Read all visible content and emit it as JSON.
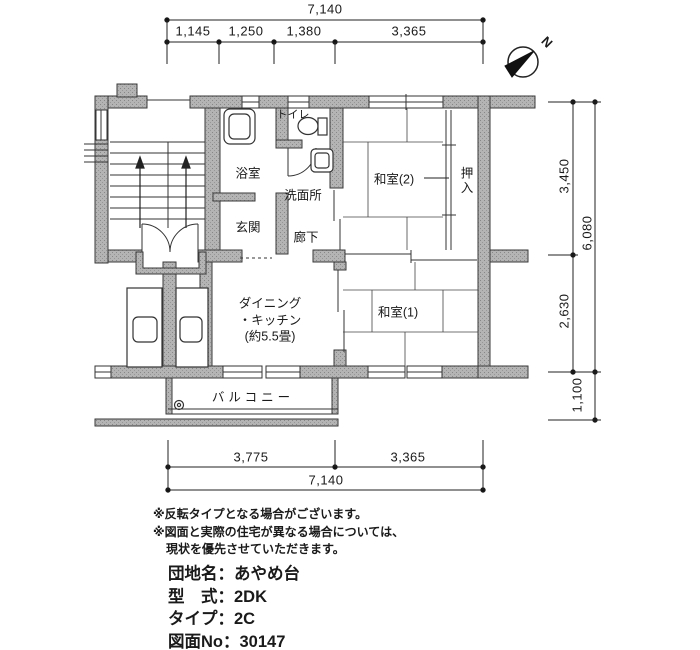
{
  "compass": {
    "north_label": "N"
  },
  "dims": {
    "top_total": "7,140",
    "top_segs": [
      "1,145",
      "1,250",
      "1,380",
      "3,365"
    ],
    "right_segs": [
      "3,450",
      "2,630"
    ],
    "right_total": "6,080",
    "right_balcony": "1,100",
    "bottom_segs": [
      "3,775",
      "3,365"
    ],
    "bottom_total": "7,140"
  },
  "rooms": {
    "toilet": "トイレ",
    "bath": "浴室",
    "washroom": "洗面所",
    "entrance": "玄関",
    "hall": "廊下",
    "japanese_room_2": "和室(2)",
    "closet": "押入",
    "japanese_room_1": "和室(1)",
    "dk_line1": "ダイニング",
    "dk_line2": "・キッチン",
    "dk_line3": "(約5.5畳)",
    "balcony": "バルコニー"
  },
  "notes": [
    "※反転タイプとなる場合がございます。",
    "※図面と実際の住宅が異なる場合については、",
    "現状を優先させていただきます。"
  ],
  "info": [
    {
      "label": "団地名",
      "sep": "：",
      "value": "あやめ台"
    },
    {
      "label": "型　式",
      "sep": "：",
      "value": "2DK"
    },
    {
      "label": "タイプ",
      "sep": "：",
      "value": "2C"
    },
    {
      "label": "図面No",
      "sep": "：",
      "value": "30147"
    }
  ]
}
